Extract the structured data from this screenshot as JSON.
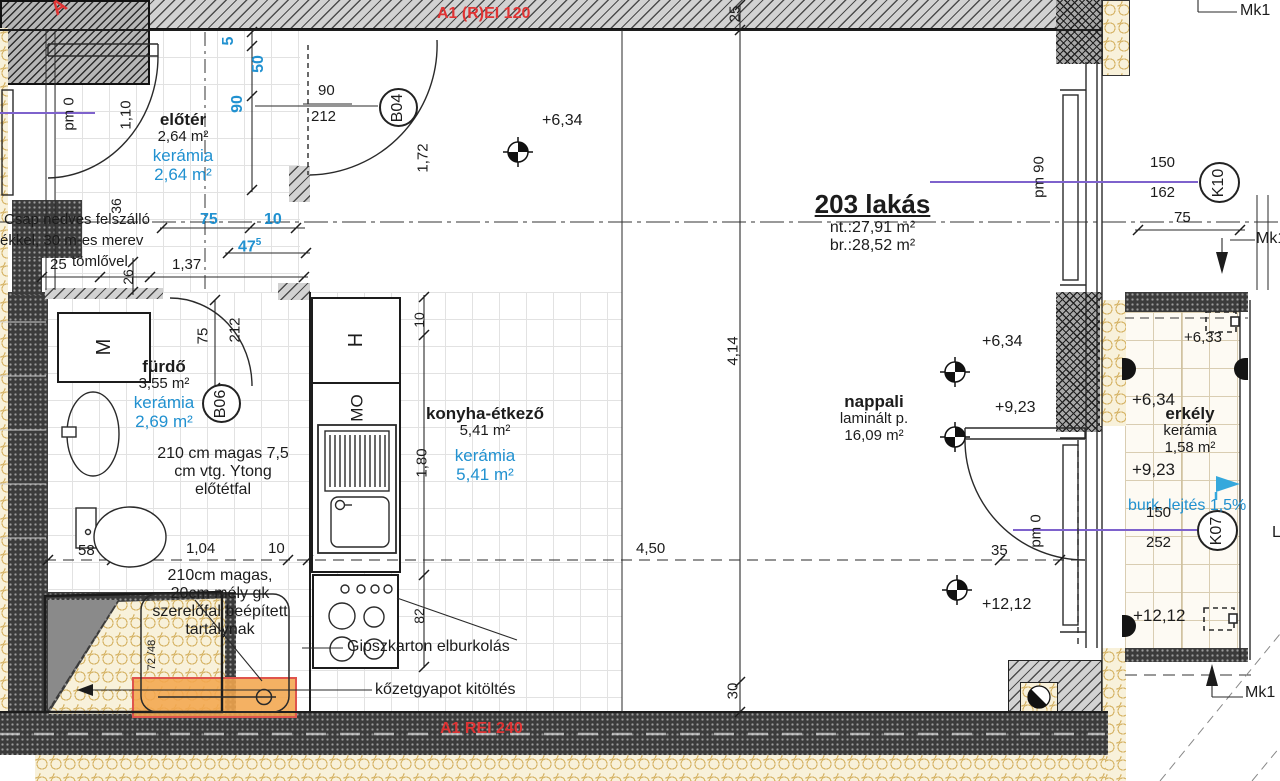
{
  "fire": {
    "top": "A1 (R)EI 120",
    "bottom": "A1 REI 240",
    "corner": "A"
  },
  "apartment": {
    "name": "203 lakás",
    "net": "nt.:27,91 m²",
    "gross": "br.:28,52 m²"
  },
  "rooms": {
    "eloter": {
      "name": "előtér",
      "area": "2,64 m²",
      "finish": "kerámia",
      "finish_area": "2,64 m²"
    },
    "furdo": {
      "name": "fürdő",
      "area": "3,55 m²",
      "finish": "kerámia",
      "finish_area": "2,69 m²"
    },
    "konyha": {
      "name": "konyha-étkező",
      "area": "5,41 m²",
      "finish": "kerámia",
      "finish_area": "5,41 m²"
    },
    "nappali": {
      "name": "nappali",
      "floor": "laminált p.",
      "area": "16,09 m²"
    },
    "erkely": {
      "name": "erkély",
      "finish": "kerámia",
      "area": "1,58 m²",
      "slope": "burk. lejtés 1,5%"
    }
  },
  "levels": {
    "kitchen": "+6,34",
    "nappali_1": "+6,34",
    "nappali_2": "+9,23",
    "nappali_3": "+12,12",
    "erkely_0": "+6,33",
    "erkely_1": "+6,34",
    "erkely_2": "+9,23",
    "erkely_3": "+12,12"
  },
  "openings": {
    "b04": "B04",
    "b06": "B06",
    "k10": "K10",
    "k07": "K07"
  },
  "notes": {
    "riser_1": "Csap nedves felszálló",
    "riser_2": "ékkel, 30 m-es merev",
    "riser_3": "tömlővel",
    "ytong_1": "210 cm magas 7,5",
    "ytong_2": "cm vtg. Ytong",
    "ytong_3": "előtétfal",
    "tank_1": "210cm magas,",
    "tank_2": "20cm mély gk",
    "tank_3": "szerelőfal beépített",
    "tank_4": "tartálynak",
    "gipsz": "Gipszkarton elburkolás",
    "kozet": "kőzetgyapot kitöltés"
  },
  "marks": {
    "mk_top": "Mk1",
    "mk_mid": "Mk1",
    "mk_bot": "Mk1",
    "l_cut": "L",
    "pm0_entry": "pm 0",
    "pm90": "pm 90",
    "pm0_terrace": "pm 0",
    "m_box": "M",
    "h_box": "H",
    "mo_box": "MO",
    "wedge": "72 /48"
  },
  "dims": {
    "b5": "5",
    "b50": "50",
    "b90": "90",
    "b75": "75",
    "b10": "10",
    "b475": "47",
    "b475_sup": "5",
    "entry_h": "1,10",
    "d36": "36",
    "d26": "26",
    "d25": "25",
    "d137": "1,37",
    "door_w": "90",
    "door_h": "212",
    "d172": "1,72",
    "top25": "25",
    "bdoor_w": "75",
    "bdoor_h": "212",
    "d58": "58",
    "d104": "1,04",
    "d10": "10",
    "k10t": "10",
    "k180": "1,80",
    "k82": "82",
    "d414": "4,14",
    "d450": "4,50",
    "d30": "30",
    "d35": "35",
    "w150": "150",
    "w162": "162",
    "w75": "75",
    "t150": "150",
    "t252": "252"
  },
  "colors": {
    "accent_blue": "#2191d0",
    "fire_red": "#e03434",
    "axis_purple": "#7e62cc",
    "tub_orange": "#f3a64d"
  }
}
